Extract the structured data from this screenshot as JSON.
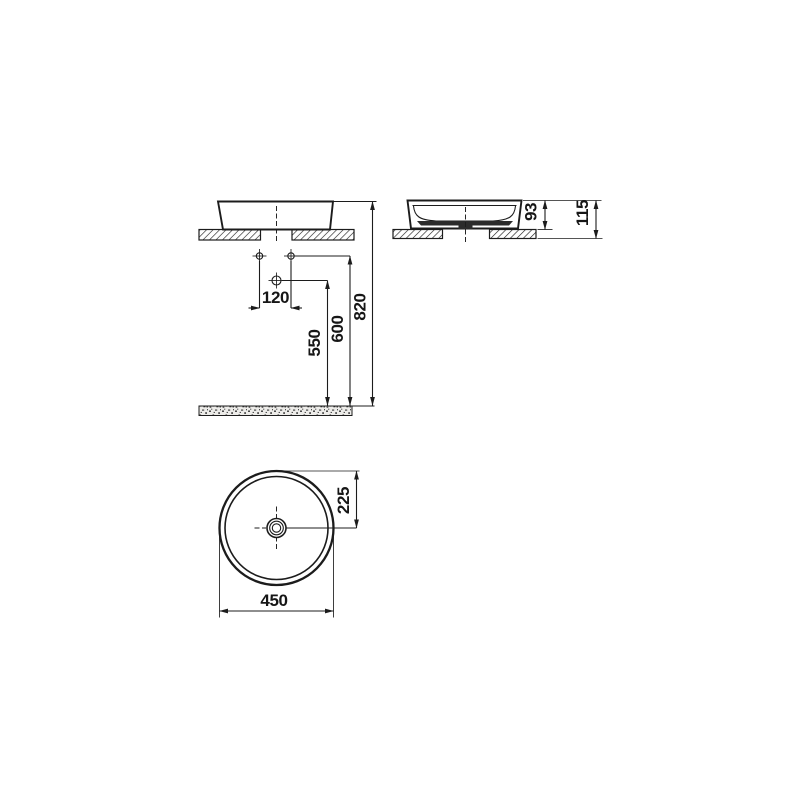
{
  "drawing": {
    "subject": "round countertop washbasin technical dimension drawing",
    "line_color": "#1c1c1c",
    "views": {
      "front": "front elevation with installation heights",
      "side": "side section on countertop",
      "top": "top plan of round basin"
    },
    "dimensions": {
      "faucet_hole_spacing": "120",
      "drain_height": "550",
      "supply_height": "600",
      "rim_height": "820",
      "height_above_counter": "93",
      "total_height": "115",
      "center_to_rim": "225",
      "diameter": "450"
    }
  }
}
